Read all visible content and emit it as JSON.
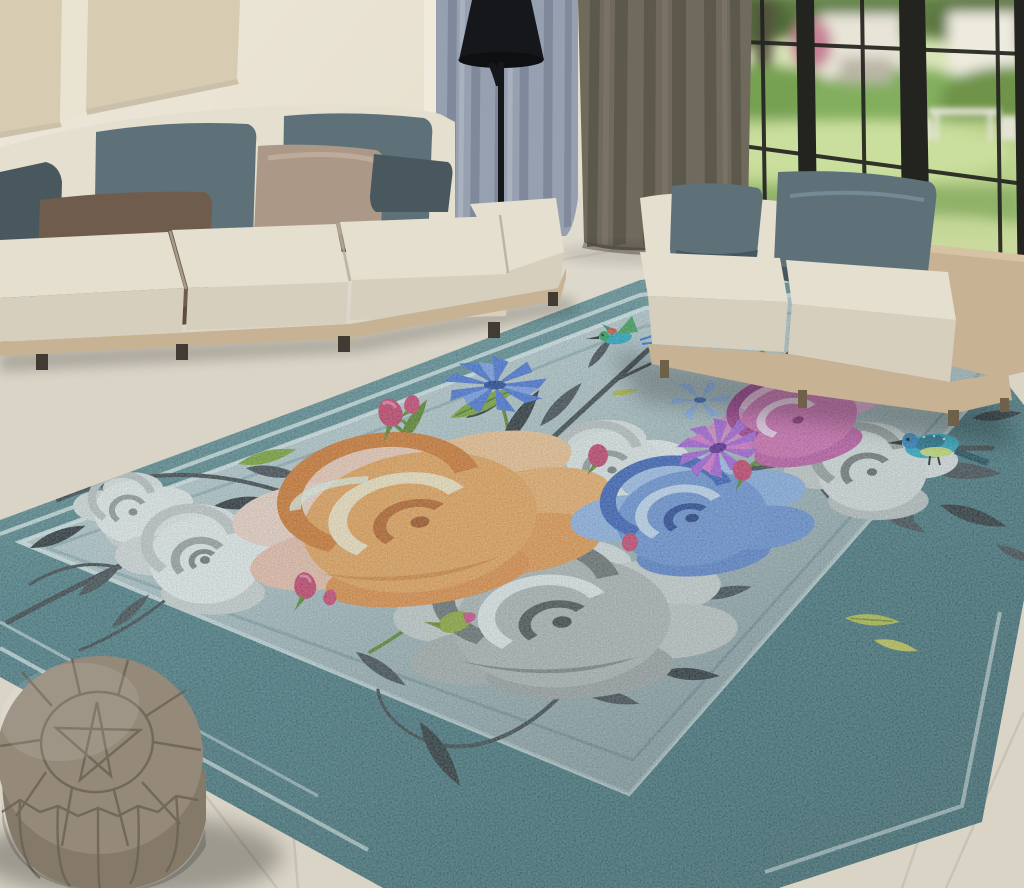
{
  "meta": {
    "type": "product-lifestyle-photo",
    "subject": "Teal floral area rug styled in a modern living room"
  },
  "palette": {
    "wall": "#e7e0cf",
    "wall-panel": "#d7cbb1",
    "floor": "#d9d4c6",
    "floor-grout": "#bfbaab",
    "window-frame": "#23231f",
    "garden-grass": "#b6d086",
    "garden-hedge": "#7daa55",
    "garden-dark": "#4c6c34",
    "curtain-blue": "#97a0b0",
    "curtain-blue-dark": "#7a8496",
    "curtain-olive": "#6f6a5c",
    "curtain-olive-dark": "#5a564a",
    "lamp": "#16171a",
    "sofa-cream": "#e5dfd0",
    "sofa-cream-front": "#d6cfbe",
    "sofa-base": "#c7b294",
    "pillow-slate": "#5e7179",
    "pillow-slate-dark": "#49585f",
    "pillow-brown": "#705c4c",
    "pillow-taupe": "#ac9887",
    "rug-border": "#4e7b81",
    "rug-field": "#bac8ca",
    "rug-stripe": "#d4e2e1",
    "pouf": "#95897a",
    "pouf-side": "#857a69",
    "pouf-seam": "#6b6254",
    "leaf-dark": "#43464a",
    "leaf-dark2": "#2b2e31",
    "leaf-green": "#7ca32e",
    "leaf-green-dark": "#5d8220",
    "leaf-yellow": "#b4bb40",
    "rose-orange": "#efa050",
    "rose-orange-deep": "#d97426",
    "rose-peach": "#f6cab4",
    "rose-cream": "#fbe4bd",
    "rose-gray": "#b3b3b1",
    "rose-gray-light": "#dcdcda",
    "rose-gray-dark": "#6e6e6c",
    "rose-blue": "#6d8fd2",
    "rose-blue-light": "#a3bce8",
    "rose-blue-dark": "#3a5cb4",
    "rose-pink": "#d666ac",
    "rose-pink-light": "#edb3d8",
    "rose-pink-dark": "#a63488",
    "rose-white": "#efefed",
    "rose-maroon": "#8e3040",
    "bud-crimson": "#cb3a64",
    "cornflower": "#4a71d6",
    "aster-purple": "#a85cd6",
    "bird-teal": "#2aa9c4",
    "bird-blue": "#2e7fc0"
  },
  "scene": {
    "wall": {
      "label": "cream wall with upholstered wall panels"
    },
    "door_trim": {
      "label": "white door casing"
    },
    "window": {
      "label": "black-framed grid window",
      "view": "garden with hedges, lawn, white house and outdoor furniture"
    },
    "curtains": {
      "left": "blue-gray drape",
      "right": "olive gray drape"
    },
    "floor_lamp": {
      "label": "black cone floor lamp"
    },
    "sofa_left": {
      "label": "beige modular sofa",
      "pillows": [
        "slate blue",
        "slate blue",
        "brown",
        "slate blue",
        "taupe leather",
        "charcoal"
      ]
    },
    "sofa_right": {
      "label": "beige armless loveseat on rug",
      "pillows": [
        "slate blue",
        "slate blue"
      ]
    },
    "rug": {
      "label": "teal bordered floral area rug",
      "border_color": "teal",
      "field_color": "pale blue-gray",
      "motifs": [
        "orange rose",
        "gray rose",
        "blue rose",
        "pink rose",
        "white roses",
        "maroon rose",
        "blue cornflower",
        "purple aster",
        "rose buds",
        "dark gray foliage",
        "green leaves",
        "flying hummingbird",
        "perched hummingbird"
      ]
    },
    "pouf": {
      "label": "taupe moroccan leather pouf"
    },
    "floor": {
      "label": "large beige stone tiles"
    }
  }
}
